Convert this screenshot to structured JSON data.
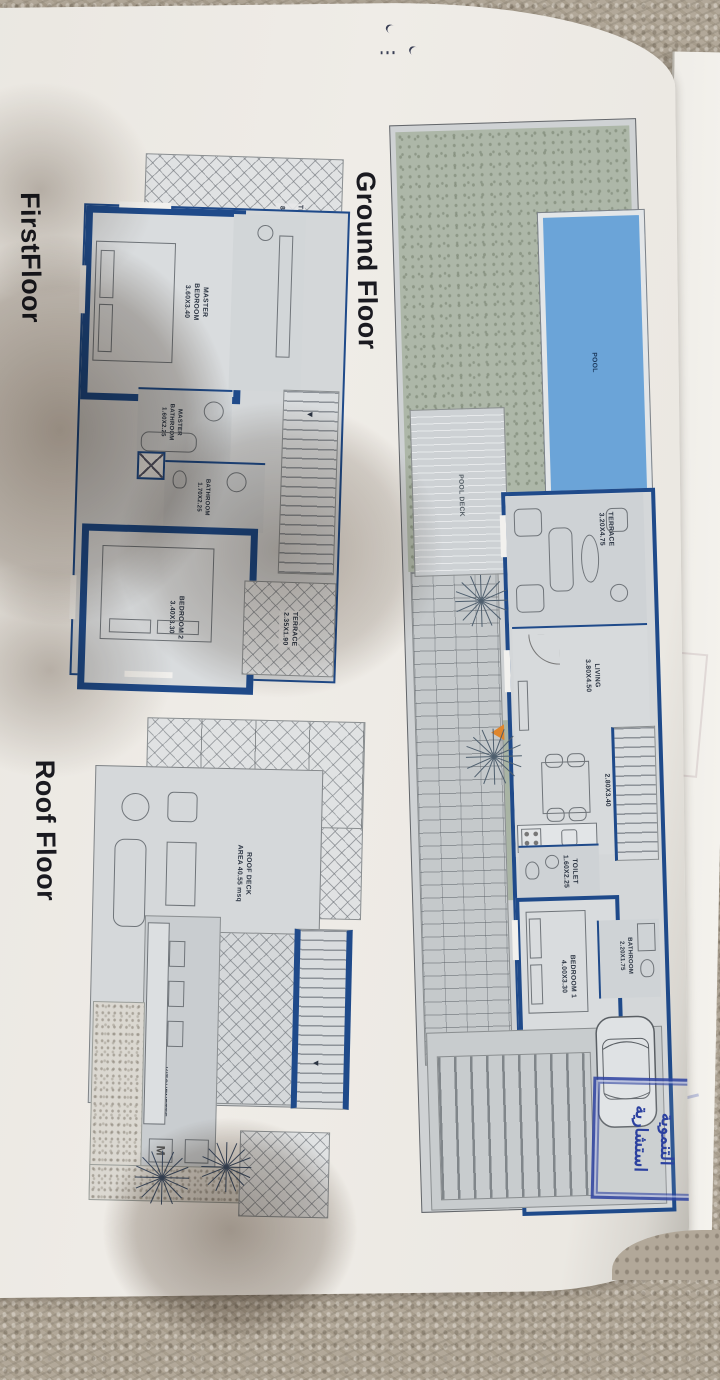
{
  "titles": {
    "first": "FirstFloor",
    "ground": "Ground Floor",
    "roof": "Roof Floor"
  },
  "ff": {
    "terrace_area": "TERRACE\nAREA\n8.95 sqm",
    "master_bedroom": "MASTER\nBEDROOM\n3.60X3.40",
    "master_bathroom": "MASTER\nBATHROOM\n1.60X2.25",
    "bathroom": "BATHROOM\n1.70X2.25",
    "bedroom2": "BEDROOM 2\n3.40X3.30",
    "terrace2": "TERRACE\n2.35X1.90"
  },
  "gf": {
    "pool": "POOL",
    "pool_deck": "POOL DECK",
    "terrace": "TERRACE\n3.20X4.75",
    "living": "LIVING\n3.80X4.50",
    "kitchen_dining": "KITCH+DINING\n2.80X3.40",
    "toilet": "TOILET\n1.60X2.25",
    "bedroom1": "BEDROOM 1\n4.00X3.30",
    "bathroom": "BATHROOM\n2.20X1.75"
  },
  "rf": {
    "roof_deck": "ROOF DECK\nAREA 40.55 msq",
    "kitchenette": "KITCHENETTE"
  },
  "stamp": {
    "line1": "التنموية",
    "line2": "استشارية"
  },
  "colors": {
    "wall_navy": "#1f4a8a",
    "pool_blue": "#6ba4d8",
    "garden_green": "#adb7a8",
    "stamp_blue": "#2c41a0",
    "arrow_orange": "#e0862c"
  }
}
